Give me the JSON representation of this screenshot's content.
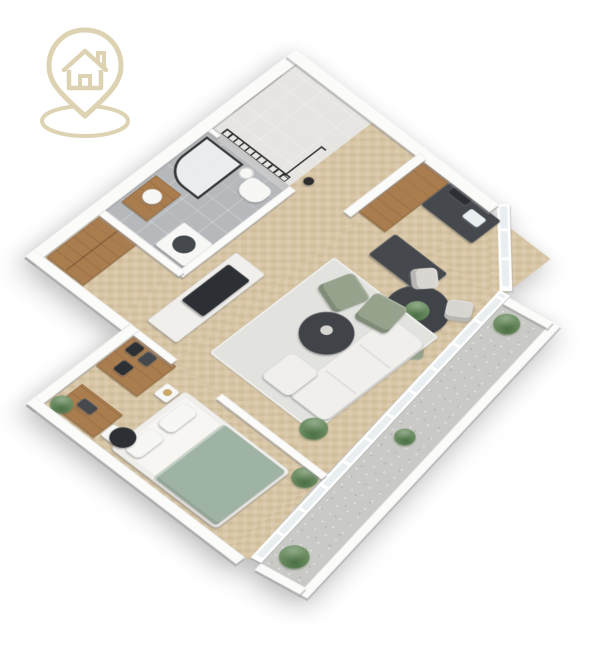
{
  "title": "3D isometric apartment floor plan render",
  "logo": {
    "name": "house-location-pin-logo",
    "color": "#ddd3b2",
    "parts": [
      "map-pin outline",
      "house with chimney and door",
      "ground ellipse"
    ]
  },
  "colors": {
    "background": "#ffffff",
    "wall": "#fbfbfa",
    "wood_floor": "#d8c6a5",
    "entry_floor": "#e6e5e2",
    "bathroom_floor": "#b6b9bc",
    "balcony_floor": "#c9c9c6",
    "glass": "#e9eef0",
    "wood_furniture": "#aa7d4f",
    "counter_dark": "#45494e",
    "table_dark": "#404449",
    "tv_dark": "#2c2f33",
    "sofa_white": "#f0efec",
    "rug": "#e2e3df",
    "sage": "#96a28c",
    "blanket_sage": "#9fb3a4",
    "chair_light": "#d8d6d1",
    "plant_green": "#6d8f63",
    "railing_dark": "#2e2e2e",
    "white_fixture": "#f7f7f5",
    "mattress": "#f7f6f3",
    "shower_glass": "#eef2f2",
    "lamp_brass": "#caa86a"
  },
  "rooms": [
    {
      "name": "entry-landing",
      "floor": "light gray",
      "furniture": [
        "entry door",
        "stair railing",
        "coat rack"
      ]
    },
    {
      "name": "bathroom",
      "floor": "gray tile",
      "furniture": [
        "walk-in shower",
        "round mirror",
        "wood vanity with basin",
        "toilet",
        "washing machine"
      ]
    },
    {
      "name": "hallway",
      "floor": "herringbone wood",
      "furniture": [
        "tall wardrobe",
        "tv console",
        "tv"
      ]
    },
    {
      "name": "kitchen",
      "floor": "herringbone wood",
      "furniture": [
        "tall wood pantry",
        "charcoal counter with sink",
        "hood",
        "kitchen island"
      ]
    },
    {
      "name": "dining-area",
      "floor": "herringbone wood",
      "furniture": [
        "round dark table",
        "table plant",
        "four chairs"
      ]
    },
    {
      "name": "living-room",
      "floor": "herringbone wood",
      "furniture": [
        "area rug",
        "white sofa",
        "chaise ottoman",
        "round coffee table",
        "two sage armchairs",
        "floor plant"
      ]
    },
    {
      "name": "bedroom",
      "floor": "herringbone wood",
      "furniture": [
        "double bed with sage blanket",
        "two pillows",
        "side tables",
        "wood shelf unit with dark bins",
        "desk",
        "office chair",
        "plants"
      ]
    },
    {
      "name": "balcony",
      "floor": "concrete",
      "furniture": [
        "parapet wall",
        "three planters"
      ]
    }
  ]
}
